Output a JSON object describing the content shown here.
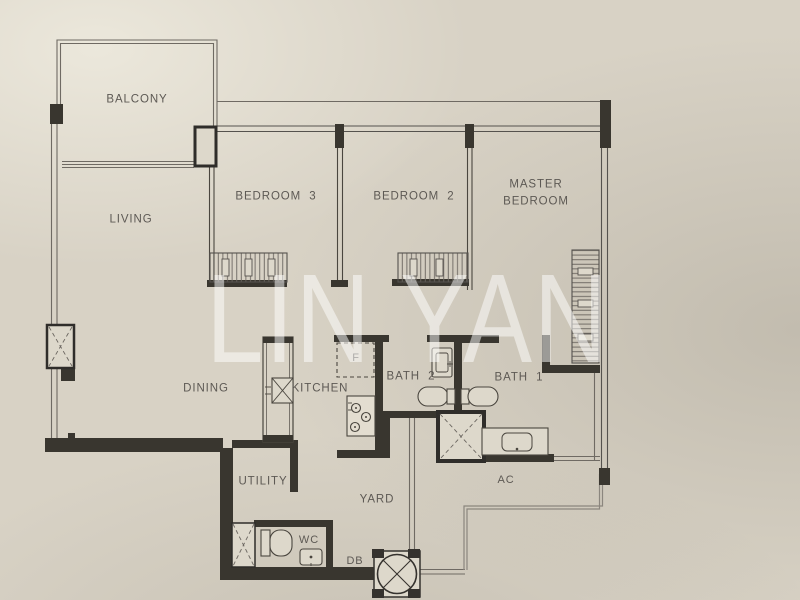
{
  "title": "Apartment floor plan",
  "watermark": "LIN YAN",
  "labels": {
    "balcony": "BALCONY",
    "living": "LIVING",
    "dining": "DINING",
    "bedroom3": "BEDROOM  3",
    "bedroom2": "BEDROOM  2",
    "master": "MASTER\nBEDROOM",
    "kitchen": "KITCHEN",
    "bath2": "BATH  2",
    "bath1": "BATH  1",
    "utility": "UTILITY",
    "yard": "YARD",
    "ac": "AC",
    "wc": "WC",
    "db": "DB",
    "fridge": "F"
  },
  "colors": {
    "paper": "#d8d2c5",
    "wall_fill": "#39362f",
    "thin_line": "#6f6a63",
    "label_text": "#5d5954",
    "watermark_white": "#ffffff"
  },
  "symbols": {
    "sink": "square-with-x-cross",
    "shaft": "box-with-dashed-x",
    "db_column": "circle-with-x-in-square",
    "wardrobe": "hatched-rectangle",
    "stove": "rect-with-3-burner-circles",
    "fridge": "dashed-square-F"
  }
}
